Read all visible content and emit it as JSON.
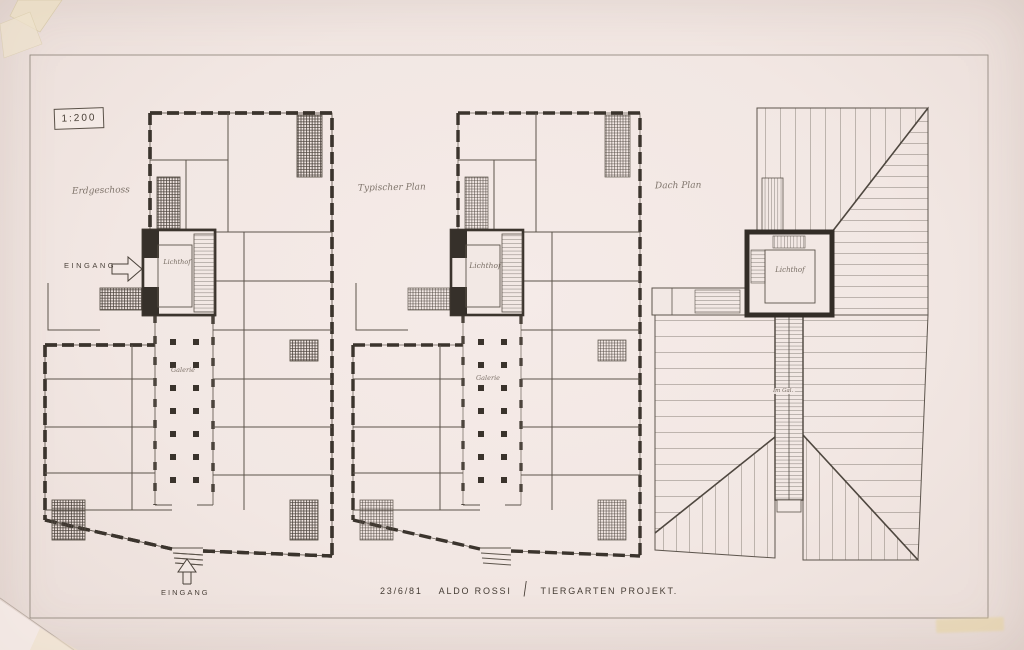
{
  "sheet": {
    "scale_label": "1:200",
    "title_block": {
      "date": "23/6/81",
      "architect": "ALDO ROSSI",
      "divider": "/",
      "project": "TIERGARTEN PROJEKT."
    }
  },
  "plans": {
    "erdgeschoss": {
      "title": "Erdgeschoss",
      "court_label": "Lichthof",
      "hall_label": "Galerie",
      "entrance_side": "EINGANG",
      "entrance_bottom": "EINGANG"
    },
    "typischer": {
      "title": "Typischer Plan",
      "court_label": "Lichthof",
      "hall_label": "Galerie"
    },
    "dach": {
      "title": "Dach Plan",
      "court_label": "Lichthof",
      "shaft_label": "Im Gal."
    }
  },
  "colors": {
    "paper": "#f2e8e4",
    "ink_thin": "#6b6259",
    "ink_wall": "#3b342d",
    "poche": "#36302a",
    "tape": "#ecdfc6",
    "stamp": "#e6d29a"
  }
}
